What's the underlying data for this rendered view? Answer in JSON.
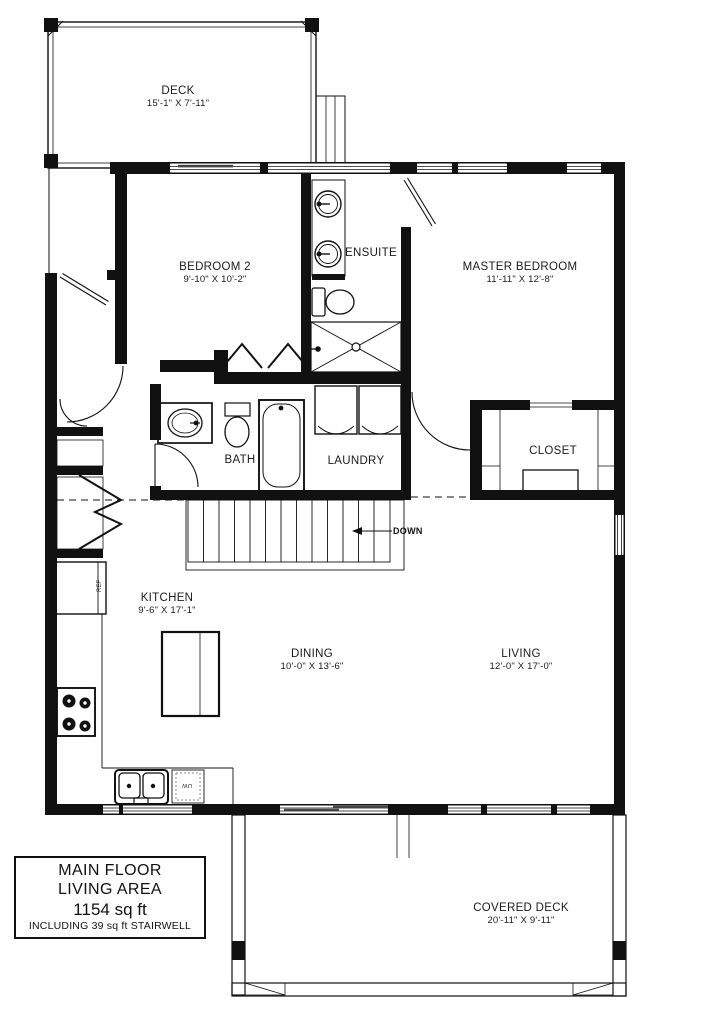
{
  "colors": {
    "background": "#ffffff",
    "wall": "#111111",
    "text": "#1b1b1b"
  },
  "rooms": {
    "deck": {
      "name": "DECK",
      "dims": "15'-1\" X 7'-11\""
    },
    "bedroom2": {
      "name": "BEDROOM 2",
      "dims": "9'-10\" X 10'-2\""
    },
    "ensuite": {
      "name": "ENSUITE"
    },
    "master_bedroom": {
      "name": "MASTER BEDROOM",
      "dims": "11'-11\" X 12'-8\""
    },
    "bath": {
      "name": "BATH"
    },
    "laundry": {
      "name": "LAUNDRY"
    },
    "closet": {
      "name": "CLOSET"
    },
    "kitchen": {
      "name": "KITCHEN",
      "dims": "9'-6\" X 17'-1\""
    },
    "dining": {
      "name": "DINING",
      "dims": "10'-0\" X 13'-6\""
    },
    "living": {
      "name": "LIVING",
      "dims": "12'-0\" X 17'-0\""
    },
    "covered_deck": {
      "name": "COVERED DECK",
      "dims": "20'-11\" X 9'-11\""
    }
  },
  "stairs": {
    "direction_label": "DOWN"
  },
  "appliances": {
    "refrigerator_label": "REF",
    "dishwasher_label": "DW"
  },
  "info_box": {
    "line1": "MAIN FLOOR",
    "line2": "LIVING AREA",
    "line3": "1154 sq ft",
    "line4": "INCLUDING 39 sq ft STAIRWELL"
  }
}
